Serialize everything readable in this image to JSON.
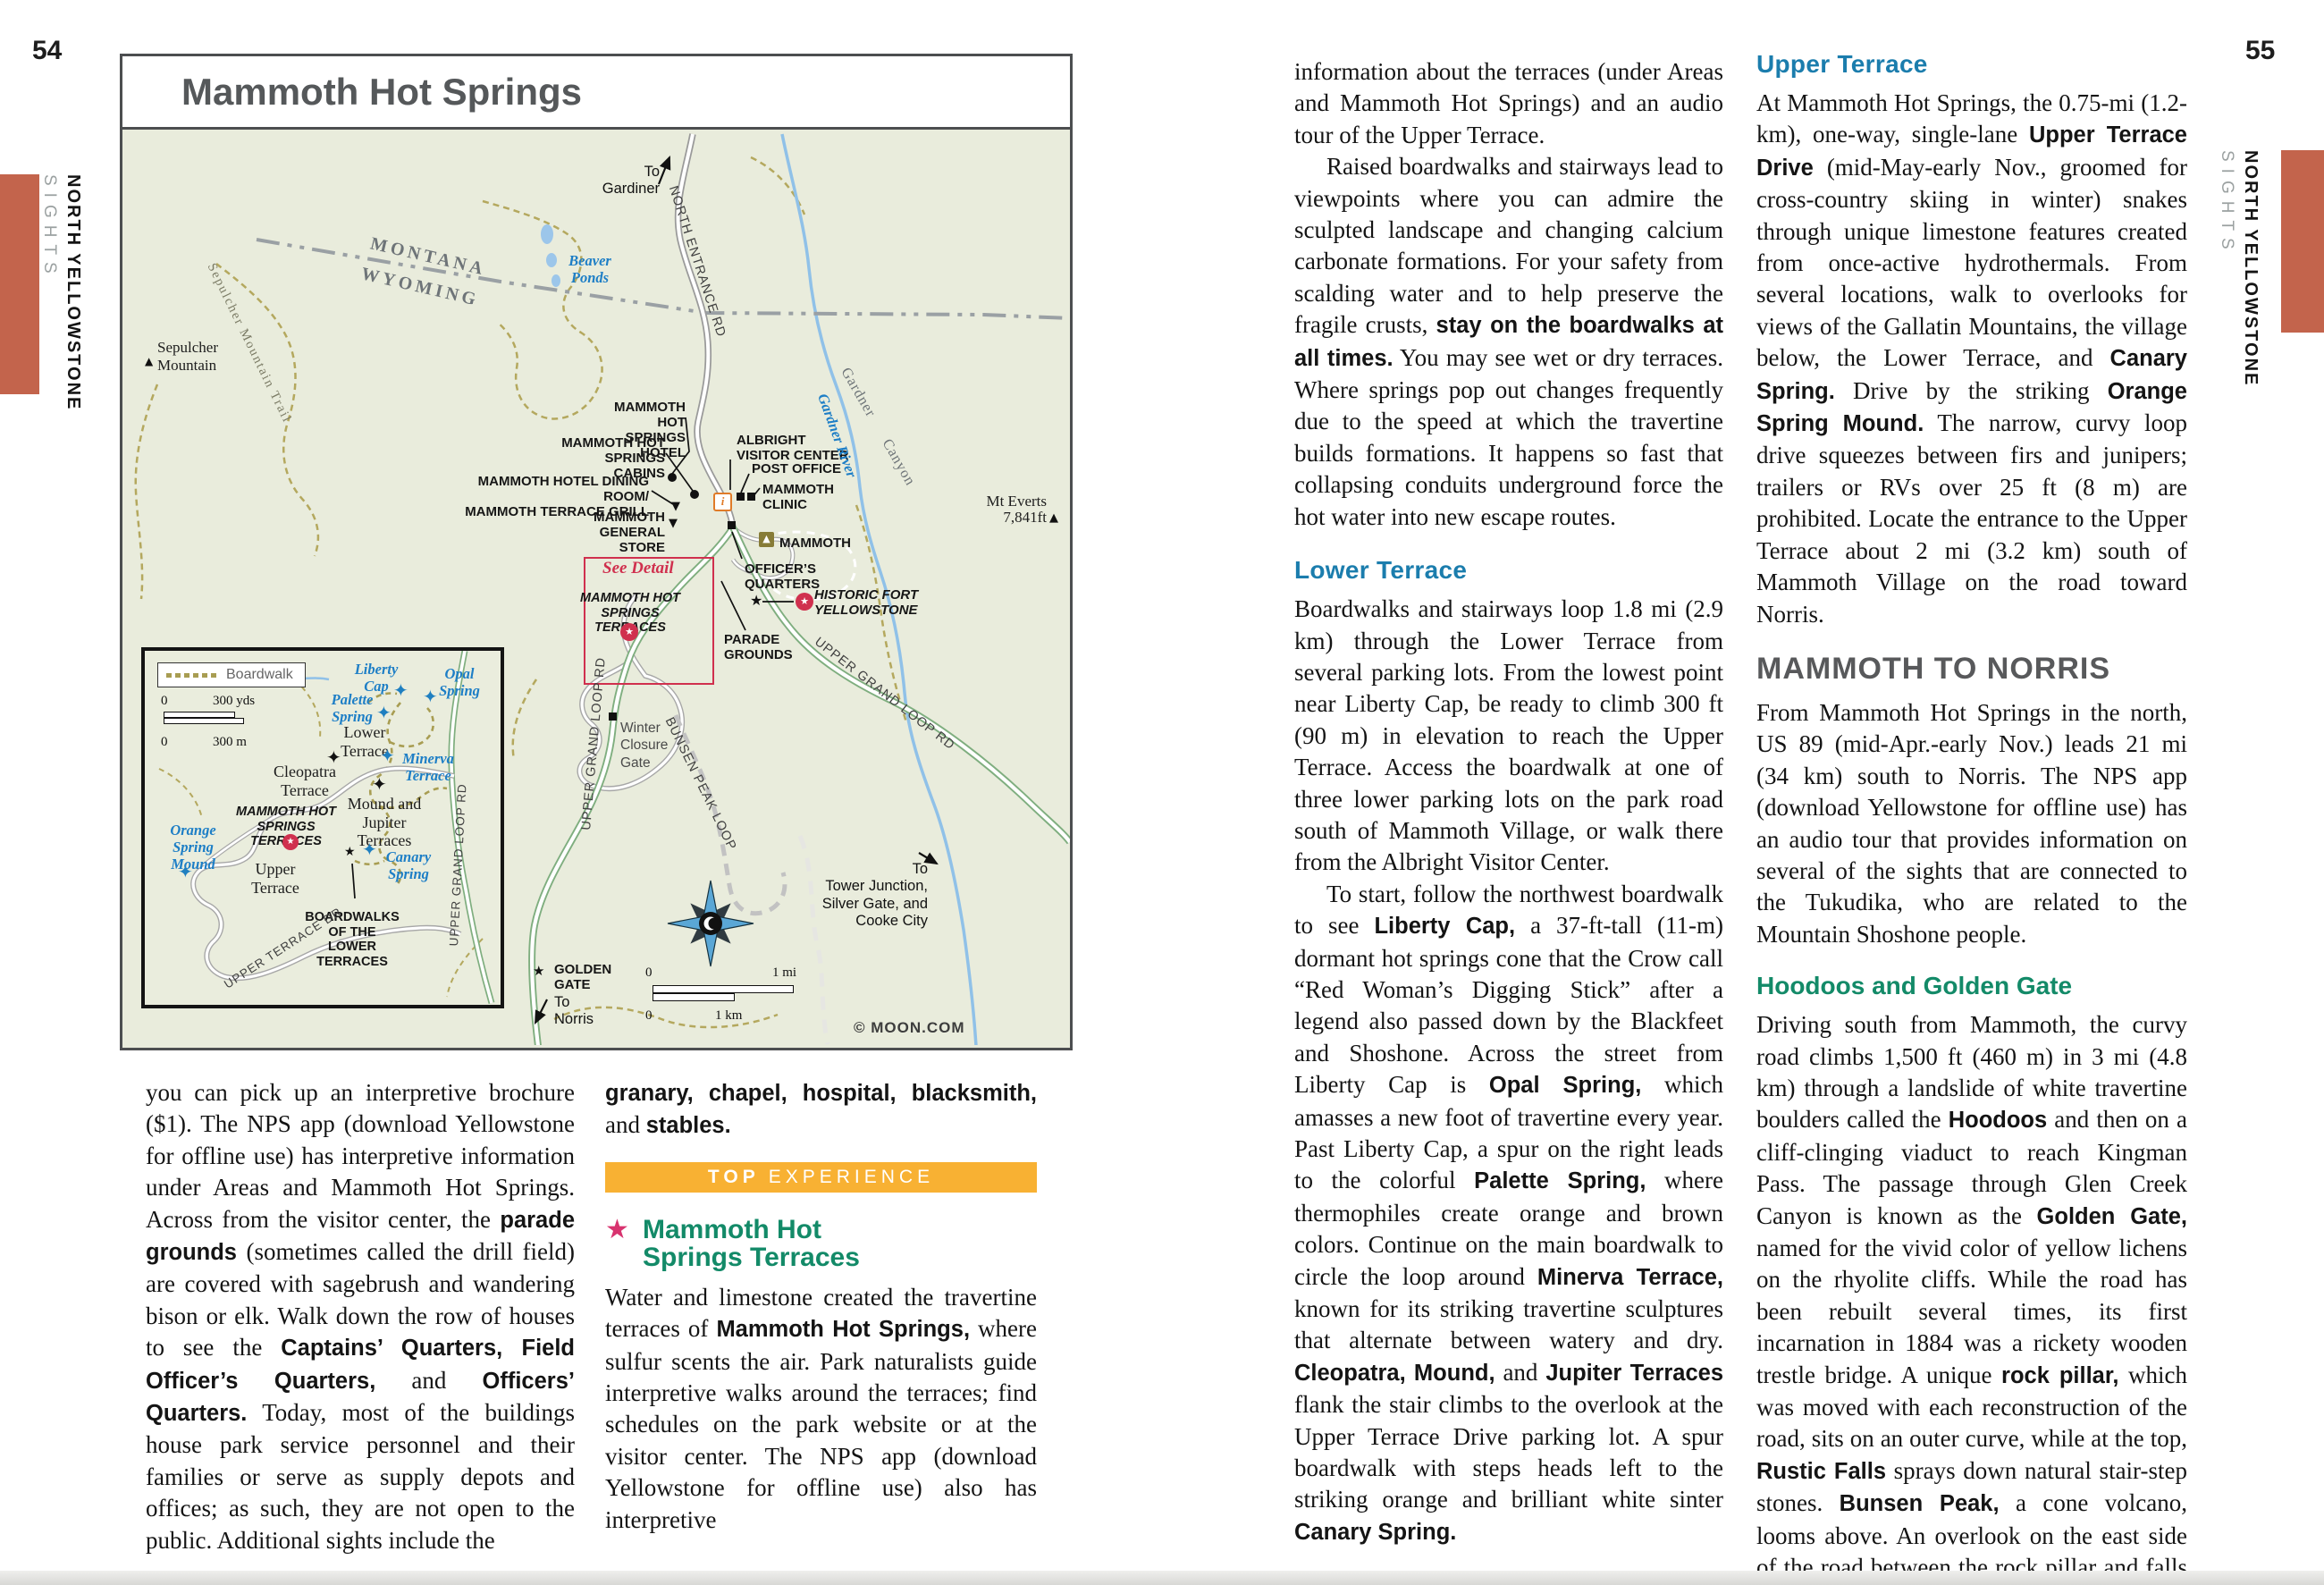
{
  "colors": {
    "tab_accent": "#c3644c",
    "banner_orange": "#f8b133",
    "heading_teal": "#138a68",
    "heading_blue": "#1b7dad",
    "heading_gray": "#58595b",
    "map_label_blue": "#1d7ec6",
    "badge_red": "#d0304e",
    "star_pink": "#d8336f",
    "map_bg": "#e9ecdc"
  },
  "pageL": {
    "num": "54",
    "tab_region": "NORTH YELLOWSTONE",
    "tab_section": "SIGHTS",
    "map": {
      "title": "Mammoth Hot Springs",
      "credit": "© MOON.COM",
      "labels": {
        "to_gardiner": "To\nGardiner",
        "north_entrance_rd": "NORTH ENTRANCE RD",
        "montana": "MONTANA",
        "wyoming": "WYOMING",
        "beaver_ponds": "Beaver\nPonds",
        "sepulcher_mtn": "Sepulcher\nMountain",
        "sepulcher_trail": "Sepulcher Mountain Trail",
        "hotel": "MAMMOTH HOT\nSPRINGS HOTEL",
        "cabins": "MAMMOTH HOT\nSPRINGS CABINS",
        "dining": "MAMMOTH HOTEL DINING ROOM/\nMAMMOTH TERRACE GRILL",
        "store": "MAMMOTH\nGENERAL STORE",
        "albright": "ALBRIGHT\nVISITOR CENTER",
        "post_office": "POST OFFICE",
        "clinic": "MAMMOTH\nCLINIC",
        "campground": "MAMMOTH",
        "officers": "OFFICER’S\nQUARTERS",
        "fort": "HISTORIC FORT\nYELLOWSTONE",
        "parade": "PARADE\nGROUNDS",
        "mt_everts": "Mt Everts",
        "mt_everts_elev": "7,841ft",
        "gardner_river": "Gardner River",
        "gardner_canyon": "Gardner Canyon",
        "see_detail": "See Detail",
        "terraces": "MAMMOTH HOT\nSPRINGS TERRACES",
        "winter_gate": "Winter\nClosure\nGate",
        "ugl_left": "UPPER GRAND LOOP RD",
        "ugl_right": "UPPER GRAND LOOP RD",
        "bunsen": "BUNSEN PEAK LOOP",
        "golden_gate": "GOLDEN\nGATE",
        "to_norris": "To\nNorris",
        "to_tower": "To\nTower Junction,\nSilver Gate, and\nCooke City",
        "scale_mi_0": "0",
        "scale_mi_1": "1 mi",
        "scale_km_0": "0",
        "scale_km_1": "1 km"
      },
      "inset": {
        "legend_boardwalk": "Boardwalk",
        "scale_yds_0": "0",
        "scale_yds": "300 yds",
        "scale_m_0": "0",
        "scale_m": "300 m",
        "liberty_cap": "Liberty\nCap",
        "opal_spring": "Opal\nSpring",
        "palette_spring": "Palette\nSpring",
        "minerva": "Minerva\nTerrace",
        "lower_terrace": "Lower\nTerrace",
        "cleopatra": "Cleopatra\nTerrace",
        "mound_jupiter": "Mound and\nJupiter\nTerraces",
        "terraces": "MAMMOTH HOT\nSPRINGS TERRACES",
        "orange_mound": "Orange\nSpring\nMound",
        "upper_terrace": "Upper\nTerrace",
        "canary": "Canary\nSpring",
        "boardwalks_lower": "BOARDWALKS\nOF THE\nLOWER TERRACES",
        "upper_terrace_dr": "UPPER TERRACE DR",
        "ugl": "UPPER GRAND LOOP RD"
      }
    },
    "colA": {
      "p1": [
        {
          "t": "you can pick up an interpretive brochure ($1). The NPS app (download Yellowstone for offline use) has interpretive information under Areas and Mammoth Hot Springs. Across from the visitor center, the "
        },
        {
          "t": "parade grounds",
          "b": true
        },
        {
          "t": " (sometimes called the drill field) are covered with sagebrush and wandering bison or elk. Walk down the row of houses to see the "
        },
        {
          "t": "Captains’ Quarters, Field Officer’s Quarters,",
          "b": true
        },
        {
          "t": " and "
        },
        {
          "t": "Officers’ Quarters.",
          "b": true
        },
        {
          "t": " Today, most of the buildings house park service personnel and their families or serve as supply depots and offices; as such, they are not open to the public. Additional sights include the"
        }
      ]
    },
    "colB": {
      "p0": [
        {
          "t": "granary, chapel, hospital, blacksmith,",
          "b": true
        },
        {
          "t": " and "
        },
        {
          "t": "stables.",
          "b": true
        }
      ],
      "banner_top": "TOP",
      "banner_rest": "EXPERIENCE",
      "star": "★",
      "h1a": "Mammoth Hot",
      "h1b": "Springs Terraces",
      "p1": [
        {
          "t": "Water and limestone created the travertine terraces of "
        },
        {
          "t": "Mammoth Hot Springs,",
          "b": true
        },
        {
          "t": " where sulfur scents the air. Park naturalists guide interpretive walks around the terraces; find schedules on the park website or at the visitor center. The NPS app (download Yellowstone for offline use) also has interpretive"
        }
      ]
    }
  },
  "pageR": {
    "num": "55",
    "tab_region": "NORTH YELLOWSTONE",
    "tab_section": "SIGHTS",
    "col1": {
      "p1": [
        {
          "t": "information about the terraces (under Areas and Mammoth Hot Springs) and an audio tour of the Upper Terrace."
        }
      ],
      "p2": [
        {
          "t": "Raised boardwalks and stairways lead to viewpoints where you can admire the sculpted landscape and changing calcium carbonate formations. For your safety from scalding water and to help preserve the fragile crusts, "
        },
        {
          "t": "stay on the boardwalks at all times.",
          "b": true
        },
        {
          "t": " You may see wet or dry terraces. Where springs pop out changes frequently due to the speed at which the travertine builds formations. It happens so fast that collapsing conduits underground force the hot water into new escape routes."
        }
      ],
      "h_lower": "Lower Terrace",
      "p3": [
        {
          "t": "Boardwalks and stairways loop 1.8 mi (2.9 km) through the Lower Terrace from several parking lots. From the lowest point near Liberty Cap, be ready to climb 300 ft (90 m) in elevation to reach the Upper Terrace. Access the boardwalk at one of three lower parking lots on the park road south of Mammoth Village, or walk there from the Albright Visitor Center."
        }
      ],
      "p4": [
        {
          "t": "To start, follow the northwest boardwalk to see "
        },
        {
          "t": "Liberty Cap,",
          "b": true
        },
        {
          "t": " a 37-ft-tall (11-m) dormant hot springs cone that the Crow call “Red Woman’s Digging Stick” after a legend also passed down by the Blackfeet and Shoshone. Across the street from Liberty Cap is "
        },
        {
          "t": "Opal Spring,",
          "b": true
        },
        {
          "t": " which amasses a new foot of travertine every year. Past Liberty Cap, a spur on the right leads to the colorful "
        },
        {
          "t": "Palette Spring,",
          "b": true
        },
        {
          "t": " where thermophiles create orange and brown colors. Continue on the main boardwalk to circle the loop around "
        },
        {
          "t": "Minerva Terrace,",
          "b": true
        },
        {
          "t": " known for its striking travertine sculptures that alternate between watery and dry. "
        },
        {
          "t": "Cleopatra, Mound,",
          "b": true
        },
        {
          "t": " and "
        },
        {
          "t": "Jupiter Terraces",
          "b": true
        },
        {
          "t": " flank the stair climbs to the overlook at the Upper Terrace Drive parking lot. A spur boardwalk with steps heads left to the striking orange and brilliant white sinter "
        },
        {
          "t": "Canary Spring.",
          "b": true
        }
      ]
    },
    "col2": {
      "h_upper": "Upper Terrace",
      "p1": [
        {
          "t": "At Mammoth Hot Springs, the 0.75-mi (1.2-km), one-way, single-lane "
        },
        {
          "t": "Upper Terrace Drive",
          "b": true
        },
        {
          "t": " (mid-May-early Nov., groomed for cross-country skiing in winter) snakes through unique limestone features created from once-active hydrothermals. From several locations, walk to overlooks for views of the Gallatin Mountains, the village below, the Lower Terrace, and "
        },
        {
          "t": "Canary Spring.",
          "b": true
        },
        {
          "t": " Drive by the striking "
        },
        {
          "t": "Orange Spring Mound.",
          "b": true
        },
        {
          "t": " The narrow, curvy loop drive squeezes between firs and junipers; trailers or RVs over 25 ft (8 m) are prohibited. Locate the entrance to the Upper Terrace about 2 mi (3.2 km) south of Mammoth Village on the road toward Norris."
        }
      ],
      "h_norris": "MAMMOTH TO NORRIS",
      "p2": [
        {
          "t": "From Mammoth Hot Springs in the north, US 89 (mid-Apr.-early Nov.) leads 21 mi (34 km) south to Norris. The NPS app (download Yellowstone for offline use) has an audio tour that provides information on several of the sights that are connected to the Tukudika, who are related to the Mountain Shoshone people."
        }
      ],
      "h_hoodoos": "Hoodoos and Golden Gate",
      "p3": [
        {
          "t": "Driving south from Mammoth, the curvy road climbs 1,500 ft (460 m) in 3 mi (4.8 km) through a landslide of white travertine boulders called the "
        },
        {
          "t": "Hoodoos",
          "b": true
        },
        {
          "t": " and then on a cliff-clinging viaduct to reach Kingman Pass. The passage through Glen Creek Canyon is known as the "
        },
        {
          "t": "Golden Gate,",
          "b": true
        },
        {
          "t": " named for the vivid color of yellow lichens on the rhyolite cliffs. While the road has been rebuilt several times, its first incarnation in 1884 was a rickety wooden trestle bridge. A unique "
        },
        {
          "t": "rock pillar,",
          "b": true
        },
        {
          "t": " which was moved with each reconstruction of the road, sits on an outer curve, while at the top, "
        },
        {
          "t": "Rustic Falls",
          "b": true
        },
        {
          "t": " sprays down natural stair-step stones. "
        },
        {
          "t": "Bunsen Peak,",
          "b": true
        },
        {
          "t": " a cone volcano, looms above. An overlook on the east side of the road between the rock pillar and falls offers a viewing location."
        }
      ]
    }
  }
}
